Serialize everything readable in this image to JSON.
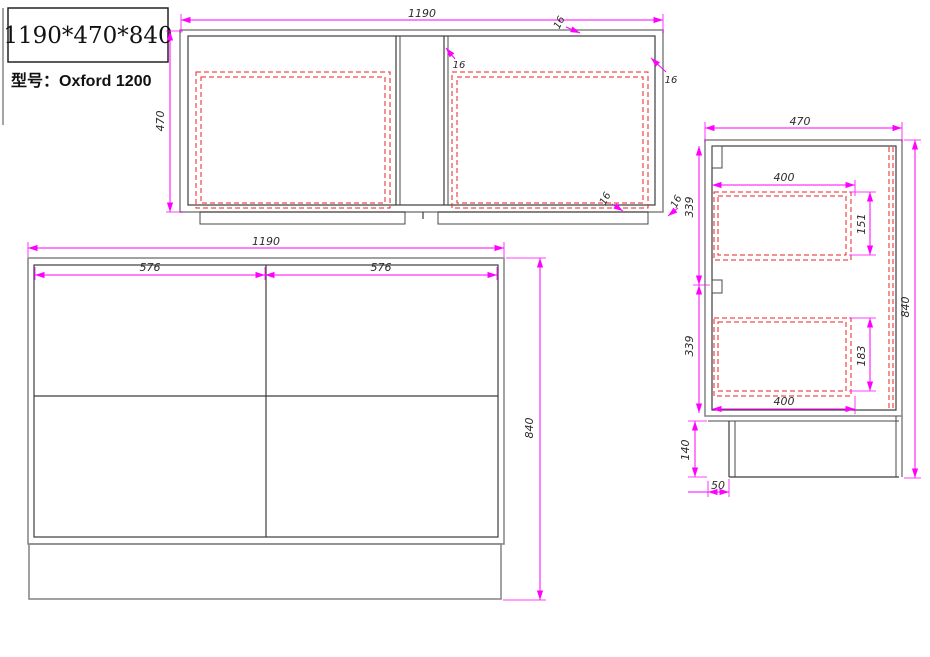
{
  "title_block": {
    "size": "1190*470*840",
    "model": "型号：Oxford 1200"
  },
  "colors": {
    "dimension_line": "#ff00ff",
    "drawing_line": "#3c3c3c",
    "hidden_line": "#ee2222",
    "dimension_text": "#2b2b2b",
    "background": "#ffffff"
  },
  "dims": {
    "top_view": {
      "width": "1190",
      "depth": "470",
      "top_panel": "16",
      "right_panel": "16",
      "divider": "16",
      "bottom_panel": "16",
      "corner": "16"
    },
    "front_view": {
      "width": "1190",
      "door_left": "576",
      "door_right": "576",
      "height": "840"
    },
    "side_view": {
      "depth": "470",
      "height": "840",
      "upper_section": "339",
      "lower_section": "339",
      "drawer_top_depth": "400",
      "drawer_top_height": "151",
      "drawer_bottom_height": "183",
      "drawer_bottom_depth": "400",
      "plinth_height": "140",
      "plinth_recess": "50"
    }
  }
}
